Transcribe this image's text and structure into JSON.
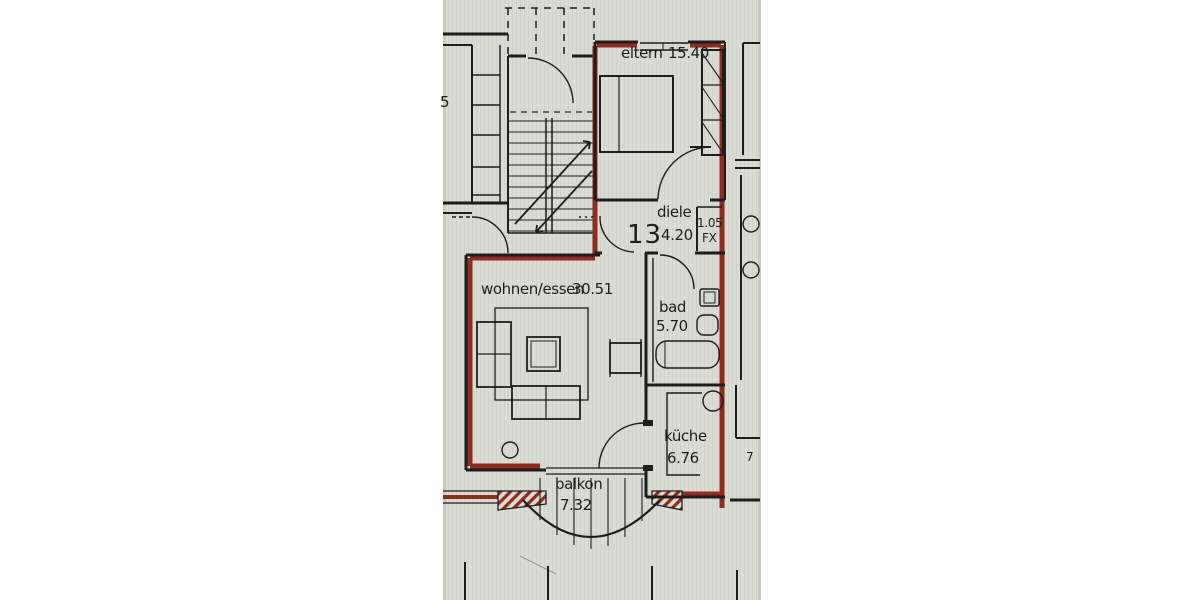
{
  "document": {
    "kind": "apartment floor plan (scanned photo)",
    "language": "de"
  },
  "colors": {
    "paper": "#dadcd3",
    "margin": "#ffffff",
    "ink": "#1d1d1d",
    "red": "#8e2c20"
  },
  "rooms": [
    {
      "id": "eltern",
      "label": "eltern",
      "area": "15.40"
    },
    {
      "id": "diele",
      "label": "diele",
      "area": "4.20"
    },
    {
      "id": "bad",
      "label": "bad",
      "area": "5.70"
    },
    {
      "id": "wohnen",
      "label": "wohnen/essen",
      "area": "30.51"
    },
    {
      "id": "kueche",
      "label": "küche",
      "area": "6.76"
    },
    {
      "id": "balkon",
      "label": "balkon",
      "area": "7.32"
    }
  ],
  "annotations": {
    "unit_number": "13",
    "shaft_dimension": "1.05",
    "shaft_code": "FX",
    "left_edge_partial": "5",
    "right_edge_partial": "7"
  }
}
